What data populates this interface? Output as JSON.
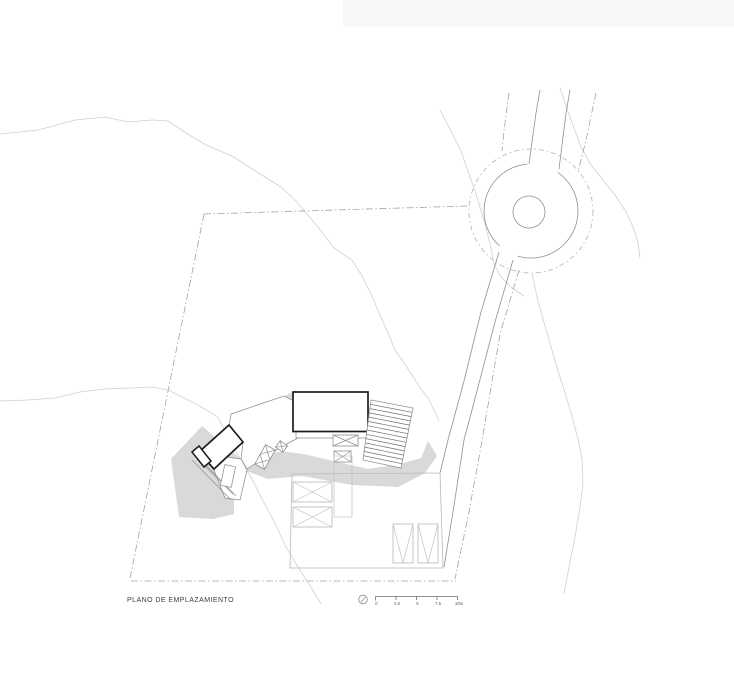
{
  "drawing": {
    "title": "PLANO DE EMPLAZAMIENTO",
    "scale_bar": {
      "tick_labels": [
        "0",
        "2.5",
        "5",
        "7.5",
        "10m"
      ]
    },
    "colors": {
      "background": "#ffffff",
      "bold_line": "#1c1c1c",
      "medium_line": "#8f8f8f",
      "light_line": "#b8b8b8",
      "contour_line": "#cfd0d2",
      "dash_line": "#a3a3a3",
      "shadow_fill": "#d9d9da",
      "top_band": "#f6f7f9"
    }
  }
}
